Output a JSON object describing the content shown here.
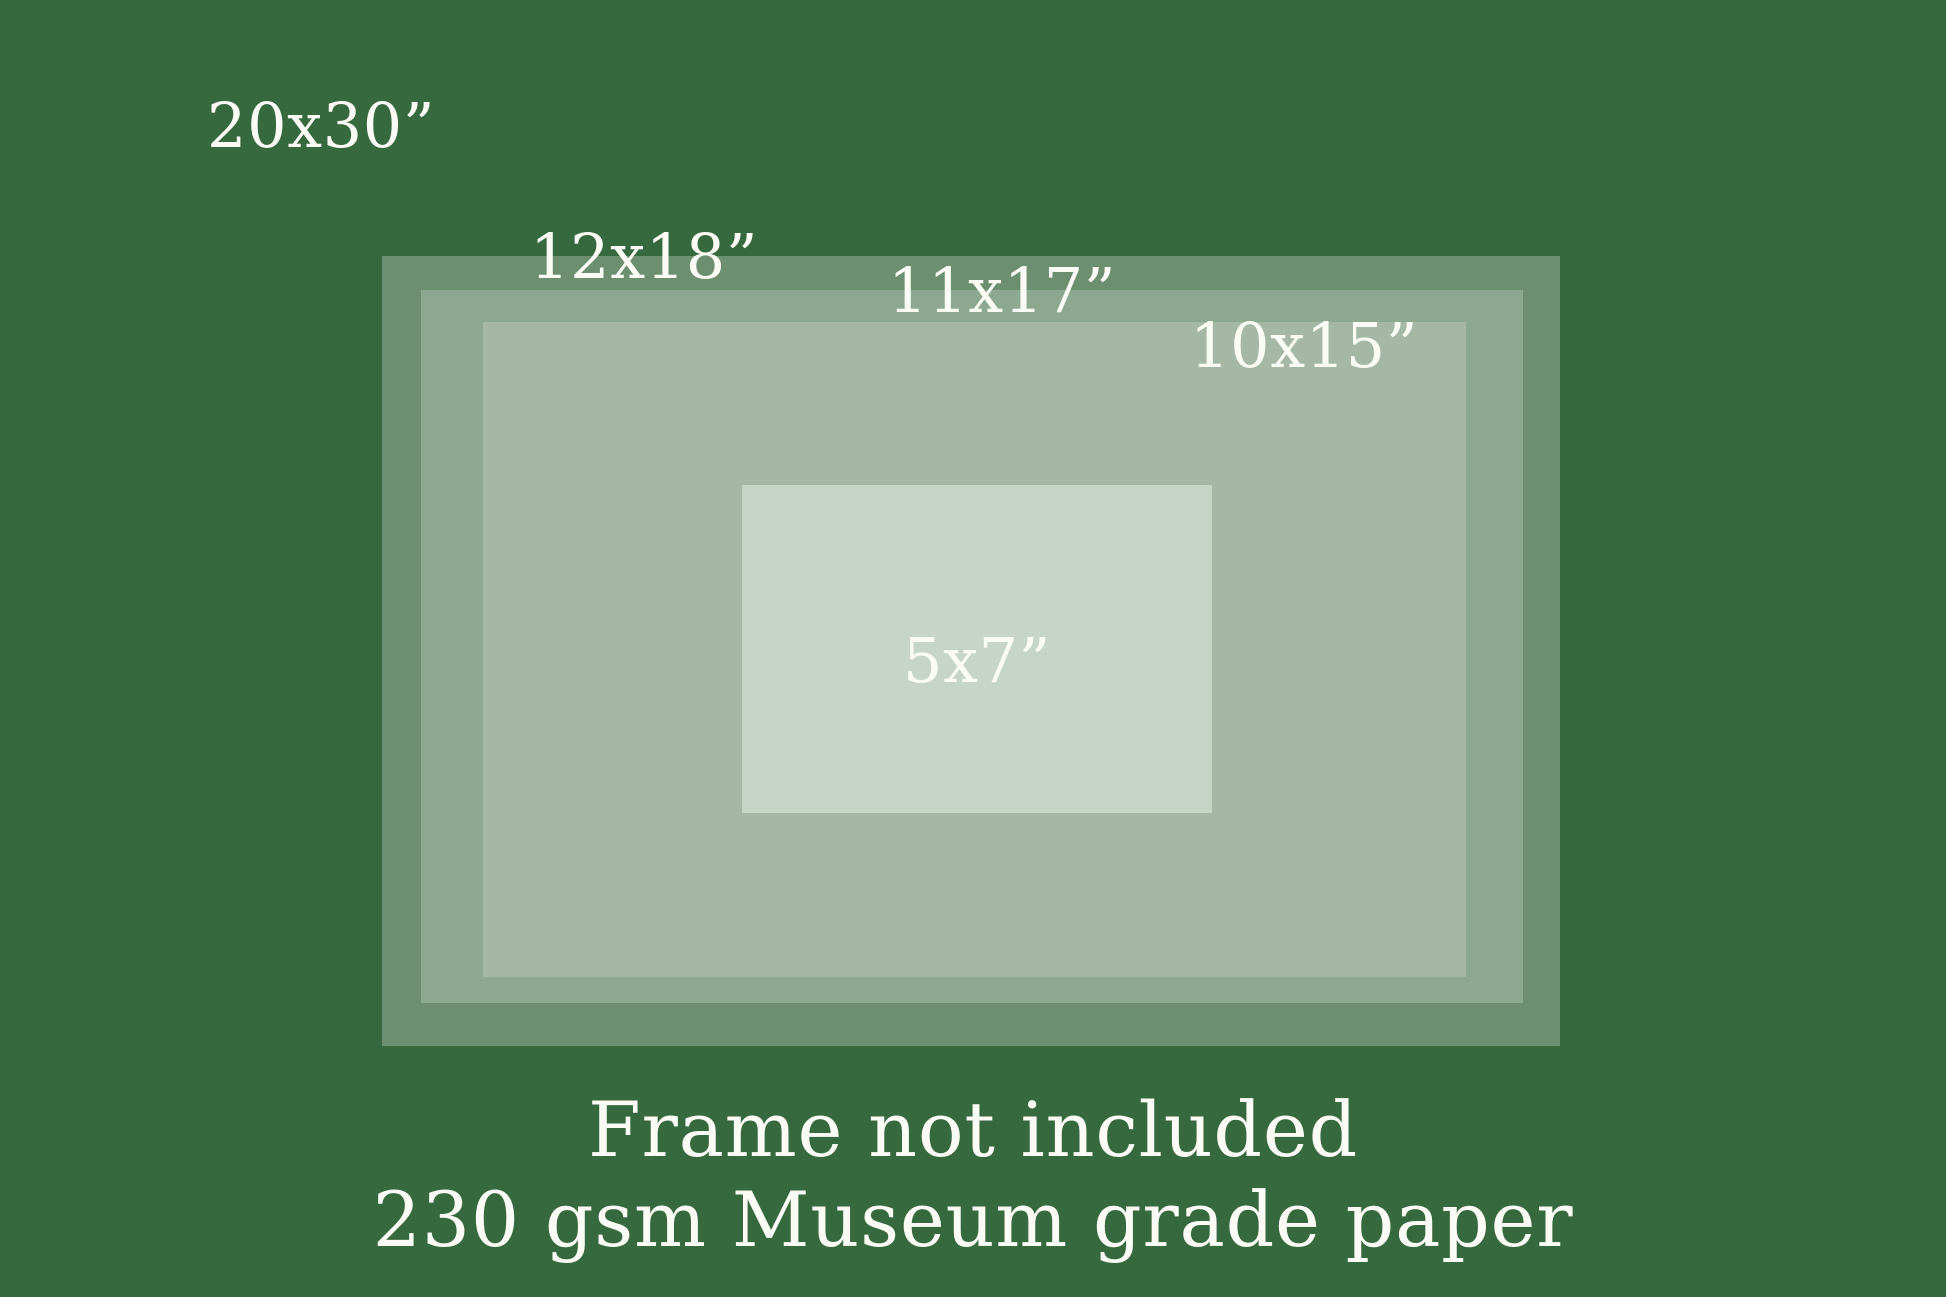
{
  "sizes": [
    {
      "label": "20x30”"
    },
    {
      "label": "12x18”"
    },
    {
      "label": "11x17”"
    },
    {
      "label": "10x15”"
    },
    {
      "label": "5x7”"
    }
  ],
  "footer": {
    "line1": "Frame not included",
    "line2": "230 gsm Museum grade paper"
  },
  "colors": {
    "background": "#36693D",
    "size_20x30_fill": "#6C8F70",
    "size_12x18_fill": "#8DA890",
    "size_11x17_and_10x15_fill": "#A4B8A5",
    "size_5x7_fill": "#C6D5C7",
    "text": "#FBFBF6"
  }
}
